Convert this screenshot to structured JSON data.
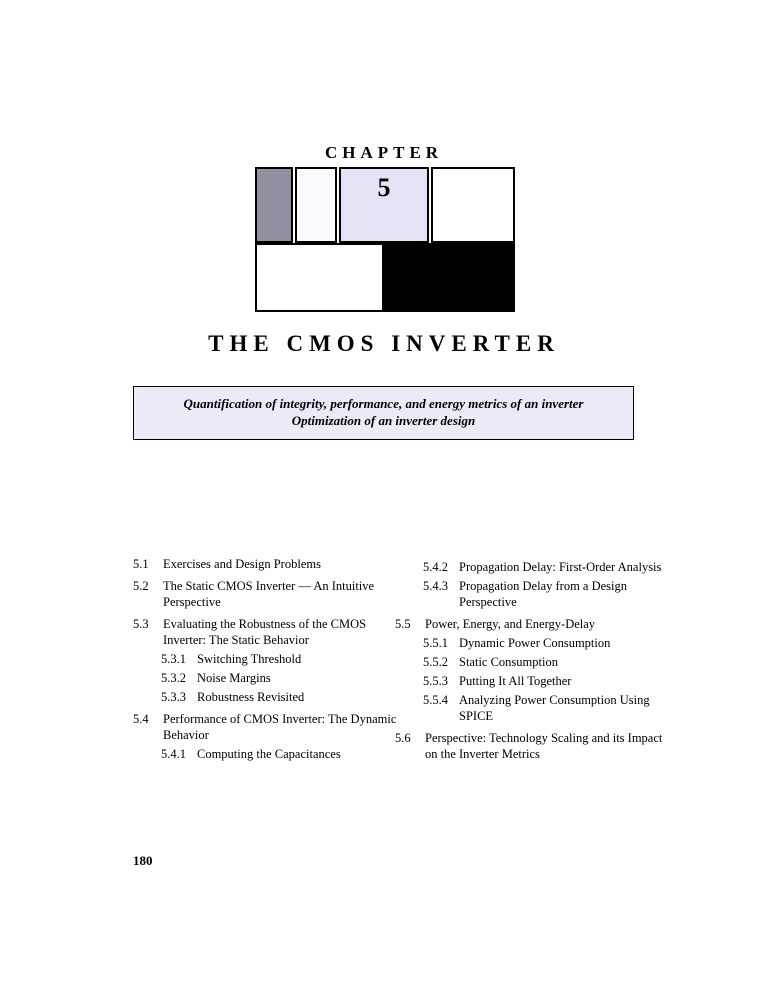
{
  "header": {
    "chapter_label": "CHAPTER",
    "chapter_number": "5",
    "title": "THE CMOS INVERTER"
  },
  "summary_box": {
    "line1": "Quantification of integrity, performance, and energy metrics of an inverter",
    "line2": "Optimization of an inverter design"
  },
  "toc": {
    "left": [
      {
        "num": "5.1",
        "label": "Exercises and Design Problems",
        "level": 1
      },
      {
        "num": "5.2",
        "label": "The Static CMOS Inverter — An Intuitive Perspective",
        "level": 1
      },
      {
        "num": "5.3",
        "label": "Evaluating the Robustness of the CMOS Inverter: The Static Behavior",
        "level": 1
      },
      {
        "num": "5.3.1",
        "label": "Switching Threshold",
        "level": 2
      },
      {
        "num": "5.3.2",
        "label": "Noise Margins",
        "level": 2
      },
      {
        "num": "5.3.3",
        "label": "Robustness Revisited",
        "level": 2
      },
      {
        "num": "5.4",
        "label": "Performance of CMOS Inverter: The Dynamic Behavior",
        "level": 1
      },
      {
        "num": "5.4.1",
        "label": "Computing the Capacitances",
        "level": 2
      }
    ],
    "right": [
      {
        "num": "5.4.2",
        "label": "Propagation Delay: First-Order Analysis",
        "level": 2
      },
      {
        "num": "5.4.3",
        "label": "Propagation Delay from a Design Perspective",
        "level": 2
      },
      {
        "num": "5.5",
        "label": "Power, Energy, and Energy-Delay",
        "level": 1
      },
      {
        "num": "5.5.1",
        "label": "Dynamic Power Consumption",
        "level": 2
      },
      {
        "num": "5.5.2",
        "label": "Static Consumption",
        "level": 2
      },
      {
        "num": "5.5.3",
        "label": "Putting It All Together",
        "level": 2
      },
      {
        "num": "5.5.4",
        "label": "Analyzing Power Consumption Using SPICE",
        "level": 2
      },
      {
        "num": "5.6",
        "label": "Perspective: Technology Scaling and its Impact on the Inverter Metrics",
        "level": 1
      }
    ]
  },
  "footer": {
    "page_number": "180"
  },
  "colors": {
    "page_bg": "#ffffff",
    "text": "#000000",
    "border": "#000000",
    "gray_cell": "#938fa0",
    "pale_cell": "#fdfbff",
    "lavender_cell": "#e5e2f5",
    "black_cell": "#000000",
    "summary_box_bg": "#edeaf7"
  }
}
